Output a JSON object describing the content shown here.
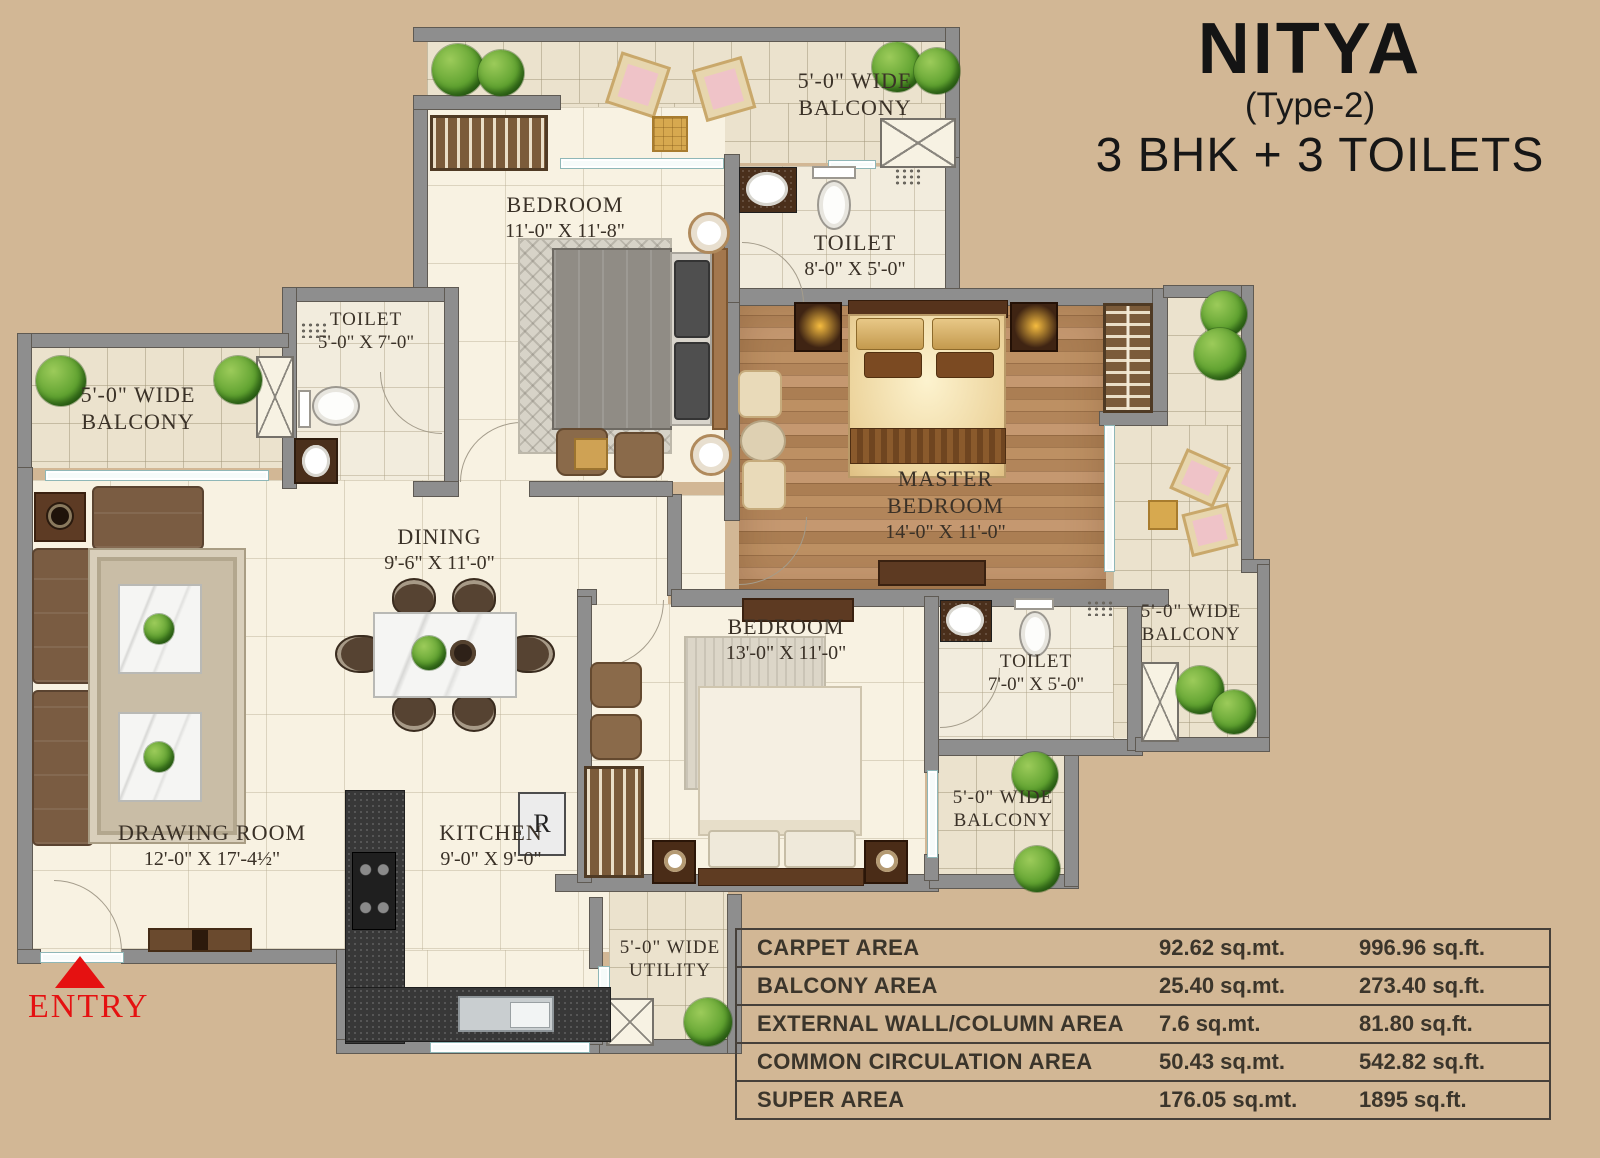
{
  "title": {
    "name": "NITYA",
    "variant": "(Type-2)",
    "config": "3 BHK + 3 TOILETS"
  },
  "entry": {
    "label": "ENTRY"
  },
  "kitchen_fridge_label": "R",
  "rooms": {
    "balcony_top": {
      "line1": "5'-0\" WIDE",
      "line2": "BALCONY"
    },
    "bedroom_top": {
      "name": "BEDROOM",
      "dims": "11'-0\" X 11'-8\""
    },
    "toilet_top": {
      "name": "TOILET",
      "dims": "8'-0\" X 5'-0\""
    },
    "toilet_left": {
      "name": "TOILET",
      "dims": "5'-0\" X 7'-0\""
    },
    "balcony_left": {
      "line1": "5'-0\" WIDE",
      "line2": "BALCONY"
    },
    "master_bedroom": {
      "name1": "MASTER",
      "name2": "BEDROOM",
      "dims": "14'-0\" X 11'-0\""
    },
    "balcony_right": {
      "line1": "5'-0\" WIDE",
      "line2": "BALCONY"
    },
    "dining": {
      "name": "DINING",
      "dims": "9'-6\" X 11'-0\""
    },
    "bedroom_mid": {
      "name": "BEDROOM",
      "dims": "13'-0\" X 11'-0\""
    },
    "toilet_mid": {
      "name": "TOILET",
      "dims": "7'-0\" X 5'-0\""
    },
    "balcony_bottom": {
      "line1": "5'-0\" WIDE",
      "line2": "BALCONY"
    },
    "utility": {
      "line1": "5'-0\" WIDE",
      "line2": "UTILITY"
    },
    "drawing_room": {
      "name": "DRAWING ROOM",
      "dims": "12'-0\" X 17'-4½\""
    },
    "kitchen": {
      "name": "KITCHEN",
      "dims": "9'-0\" X 9'-0\""
    }
  },
  "area_table": {
    "rows": [
      {
        "label": "CARPET AREA",
        "sqmt": "92.62 sq.mt.",
        "sqft": "996.96 sq.ft."
      },
      {
        "label": "BALCONY AREA",
        "sqmt": "25.40 sq.mt.",
        "sqft": "273.40 sq.ft."
      },
      {
        "label": "EXTERNAL WALL/COLUMN AREA",
        "sqmt": "7.6 sq.mt.",
        "sqft": "81.80 sq.ft."
      },
      {
        "label": "COMMON CIRCULATION AREA",
        "sqmt": "50.43 sq.mt.",
        "sqft": "542.82 sq.ft."
      },
      {
        "label": "SUPER AREA",
        "sqmt": "176.05 sq.mt.",
        "sqft": "1895 sq.ft."
      }
    ]
  },
  "colors": {
    "background": "#d2b795",
    "wall": "#8e8e8e",
    "floor": "#f8f2e2",
    "wood": "#b2855a",
    "entry_red": "#e51111",
    "text_dark": "#3a3127"
  }
}
